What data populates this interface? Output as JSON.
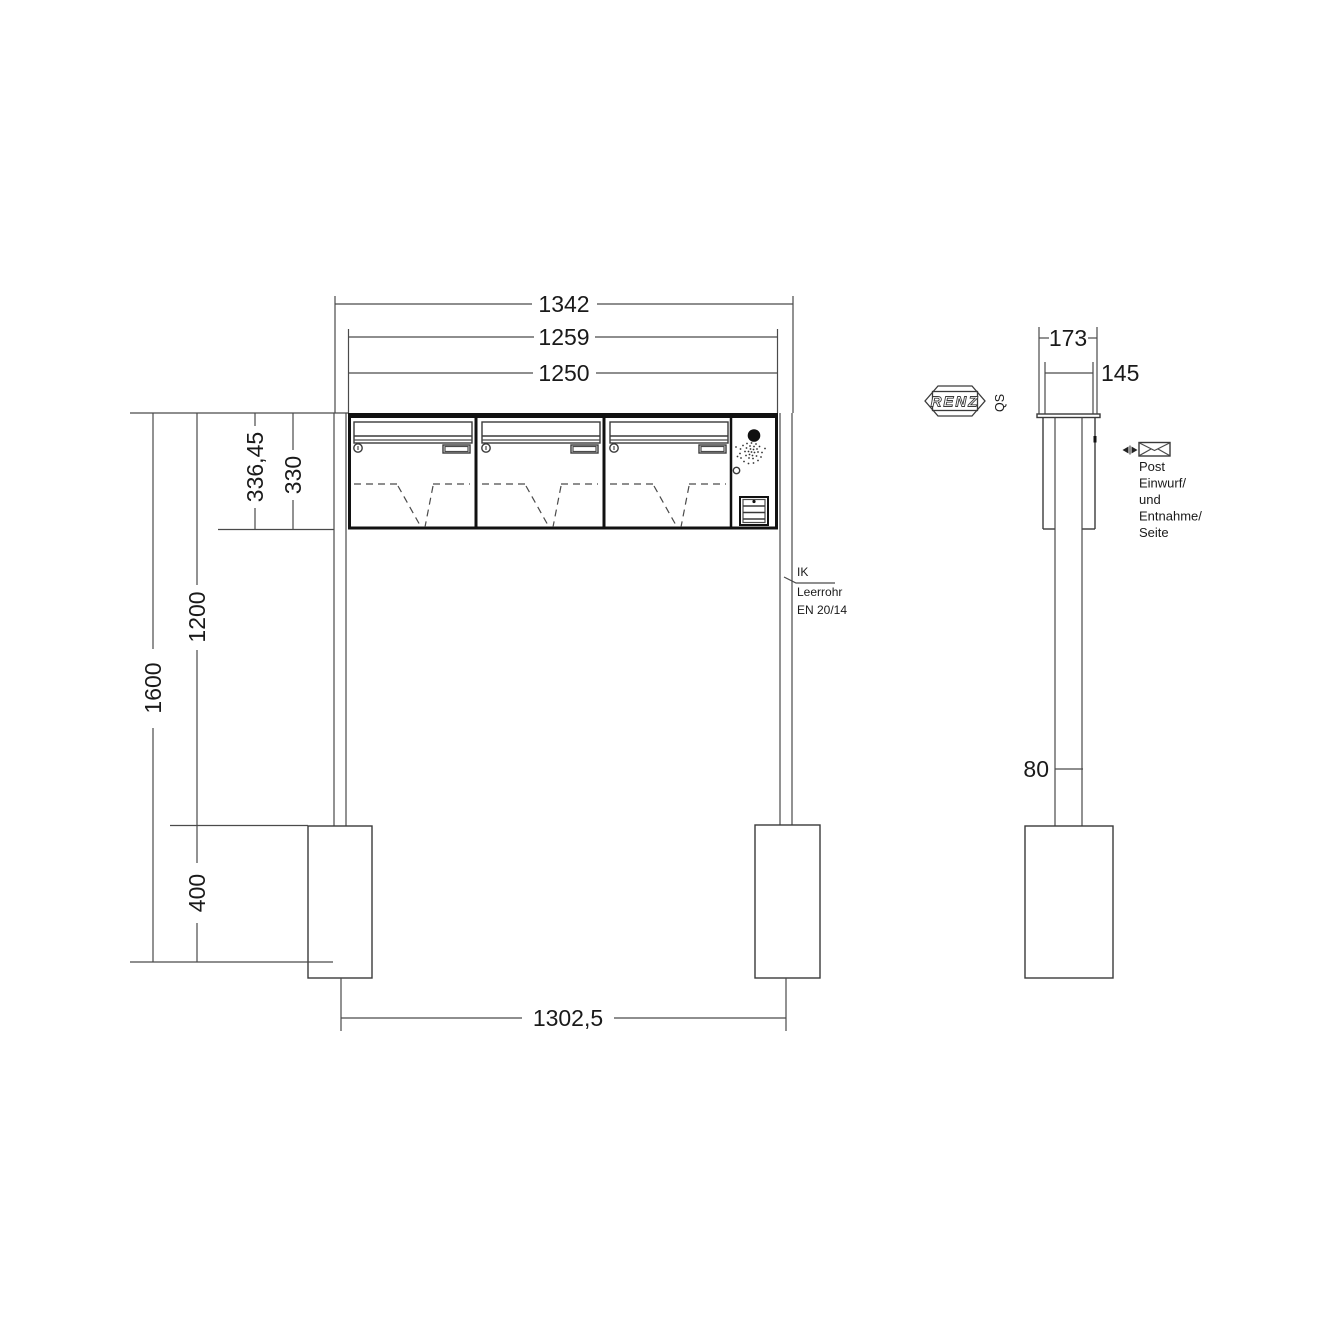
{
  "brand": {
    "name": "RENZ",
    "qs": "QS"
  },
  "front": {
    "dim_overall_width": "1342",
    "dim_body_width": "1259",
    "dim_box_width": "1250",
    "dim_box_height_outer": "336,45",
    "dim_box_height": "330",
    "dim_mount_height": "1200",
    "dim_total_height": "1600",
    "dim_foundation_depth": "400",
    "dim_post_spacing": "1302,5",
    "note_ik": "IK",
    "note_conduit": "Leerrohr",
    "note_standard": "EN 20/14"
  },
  "side": {
    "dim_overall_depth": "173",
    "dim_box_depth": "145",
    "dim_post_depth": "80",
    "note": [
      "Post",
      "Einwurf/",
      "und",
      "Entnahme/",
      "Seite"
    ]
  },
  "icons": {
    "envelope": "envelope-outline",
    "view_direction": "paired-triangles",
    "speaker": "stippled-circle",
    "camera": "filled-circle",
    "lock": "keyed-cylinder-circle"
  },
  "colors": {
    "background": "#ffffff",
    "line_thin": "#4a4a4a",
    "line_thick": "#111111",
    "text": "#1a1a1a"
  }
}
